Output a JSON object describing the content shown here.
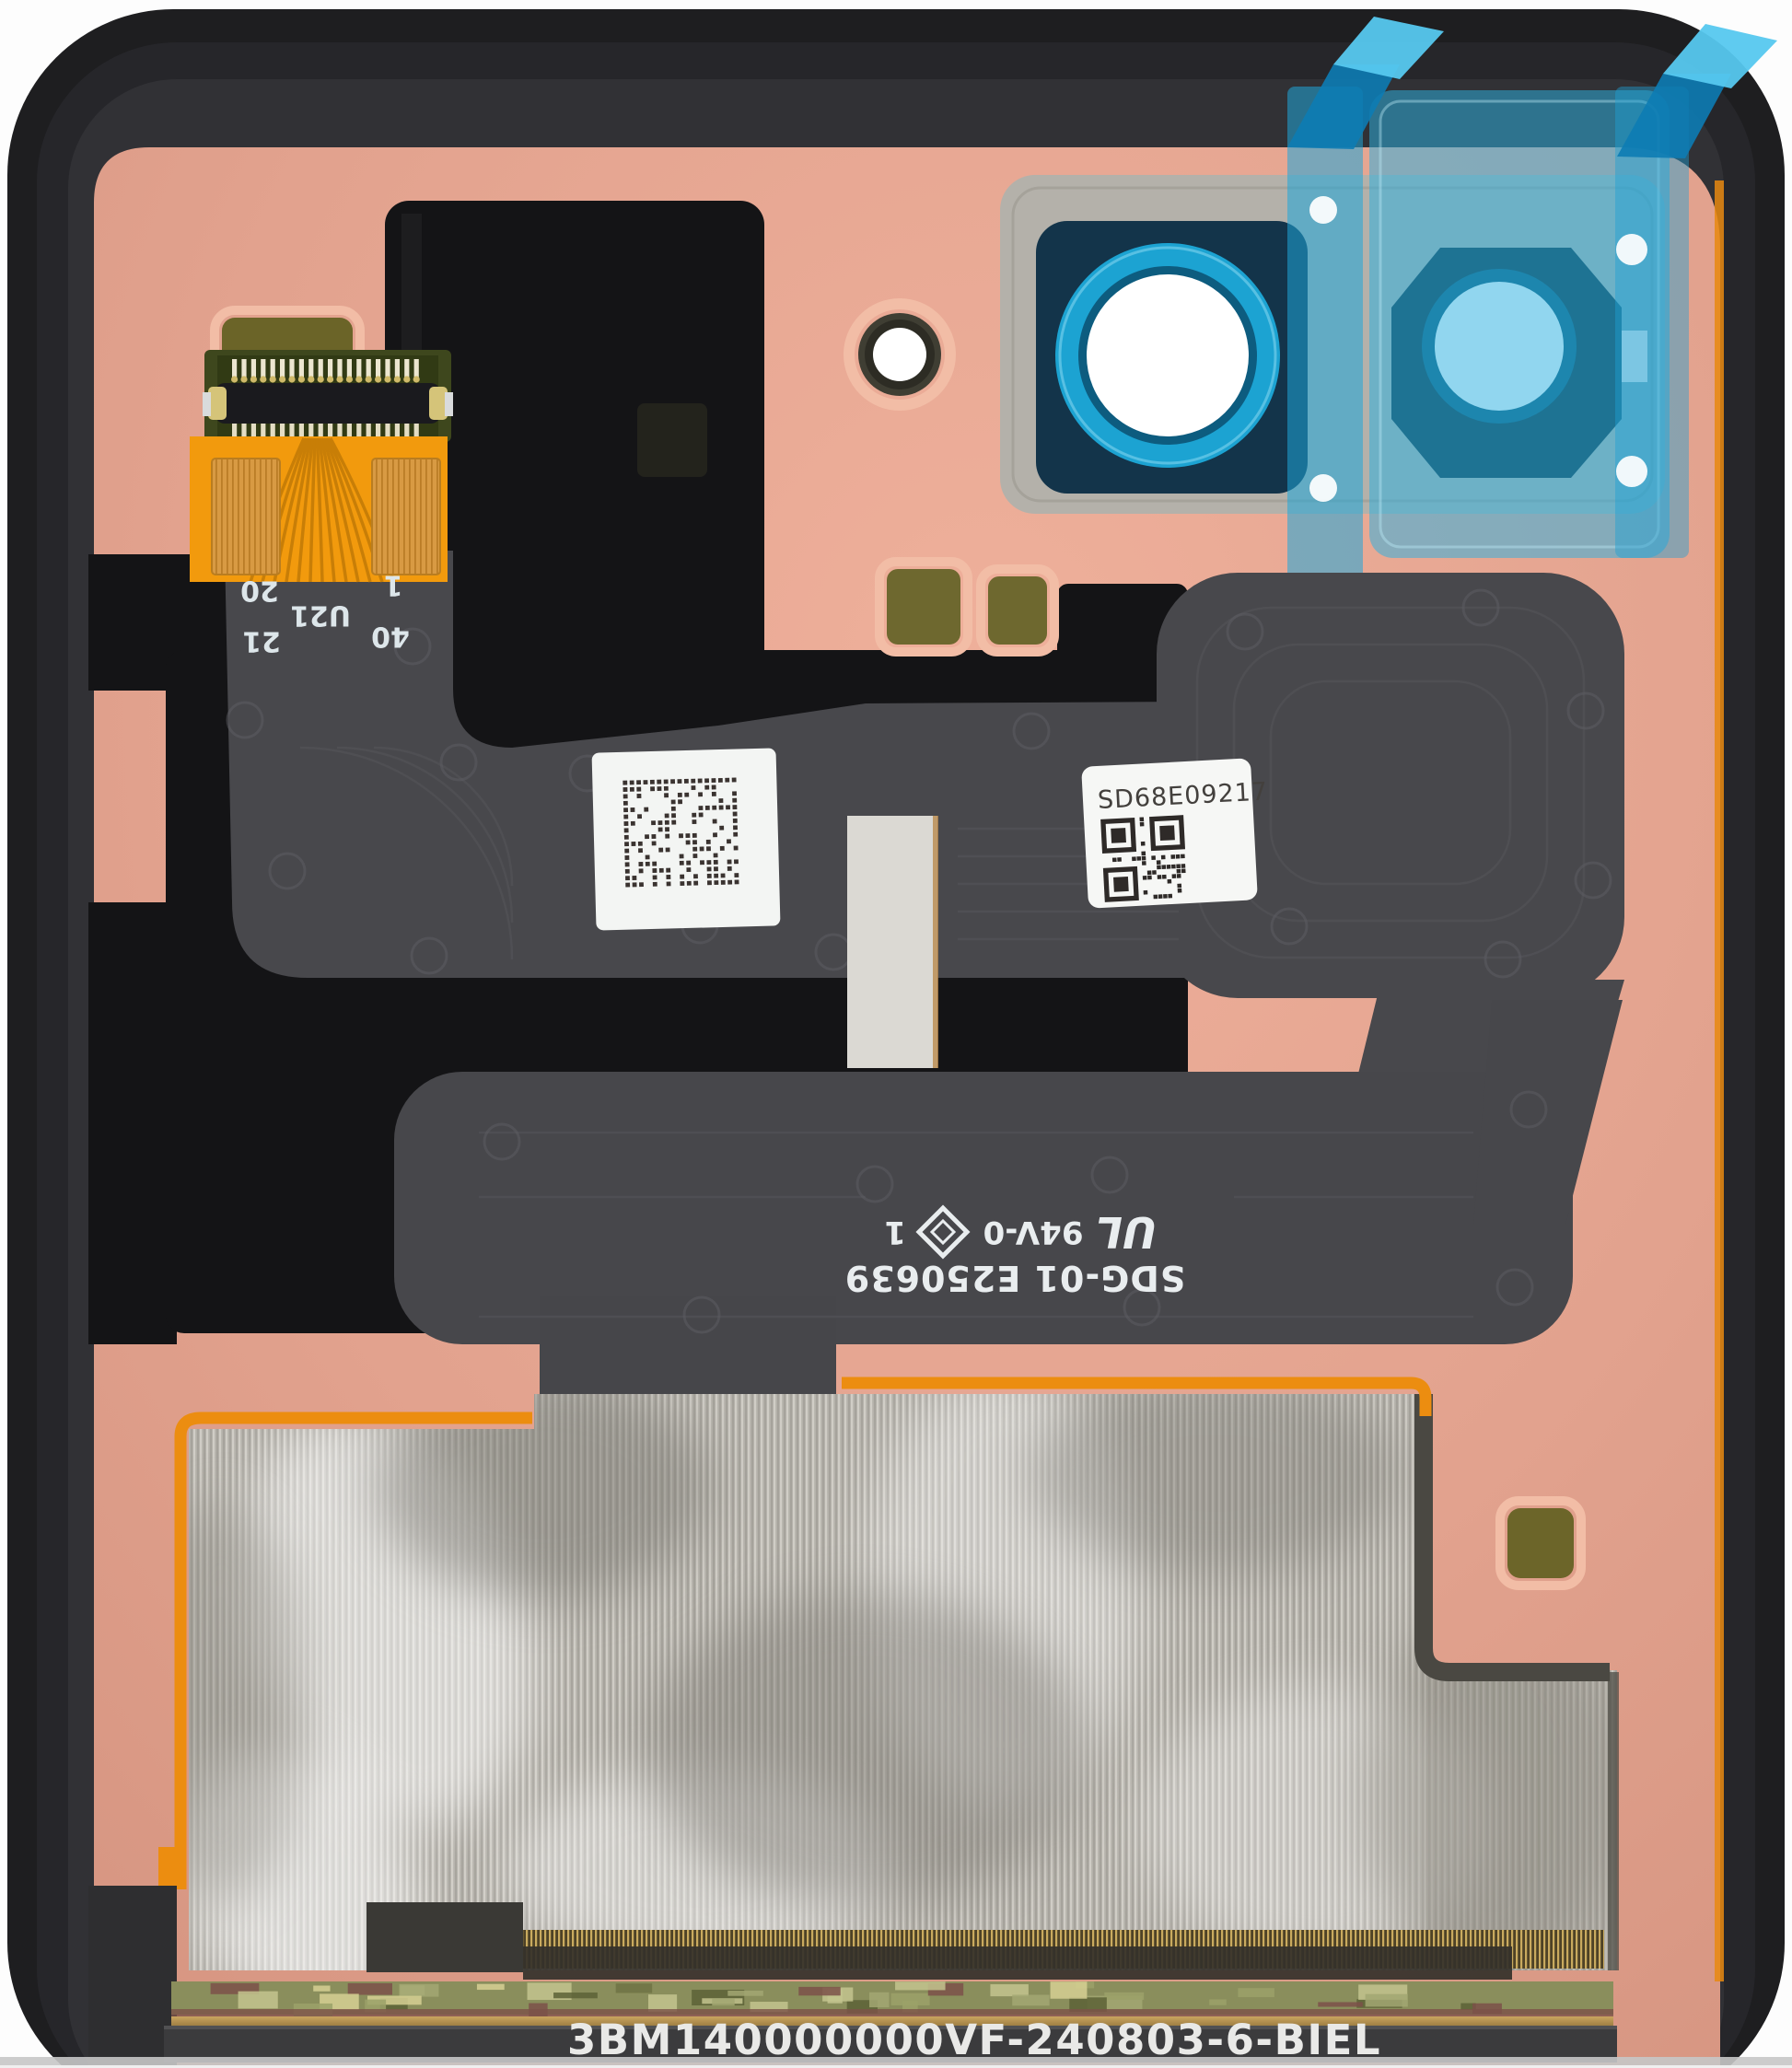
{
  "flex_connector": {
    "pin_label_1": "1",
    "pin_label_20": "20",
    "pin_label_21": "21",
    "pin_label_40": "40",
    "component_designator": "U21"
  },
  "serial_sticker": {
    "code": "SD68E09217"
  },
  "flex_print": {
    "part_number": "SDG-01 E250639",
    "ul_logo": "UL",
    "flammability_rating": "94V-0",
    "cert_index": "1"
  },
  "bottom_print": {
    "serial": "3BM140000000VF-240803-6-BIEL"
  },
  "colors": {
    "backplate_pink": "#e2a28e",
    "frame_black": "#1e1e20",
    "flex_gray": "#48484c",
    "flex_orange": "#f29a0d",
    "lens_ring_cyan": "#1ca3d2",
    "protective_film_blue": "#2cb0e0",
    "adhesive_pad_olive": "#6c6529",
    "shield_silver": "#b5b2ab",
    "label_white": "#f5f6f4"
  }
}
